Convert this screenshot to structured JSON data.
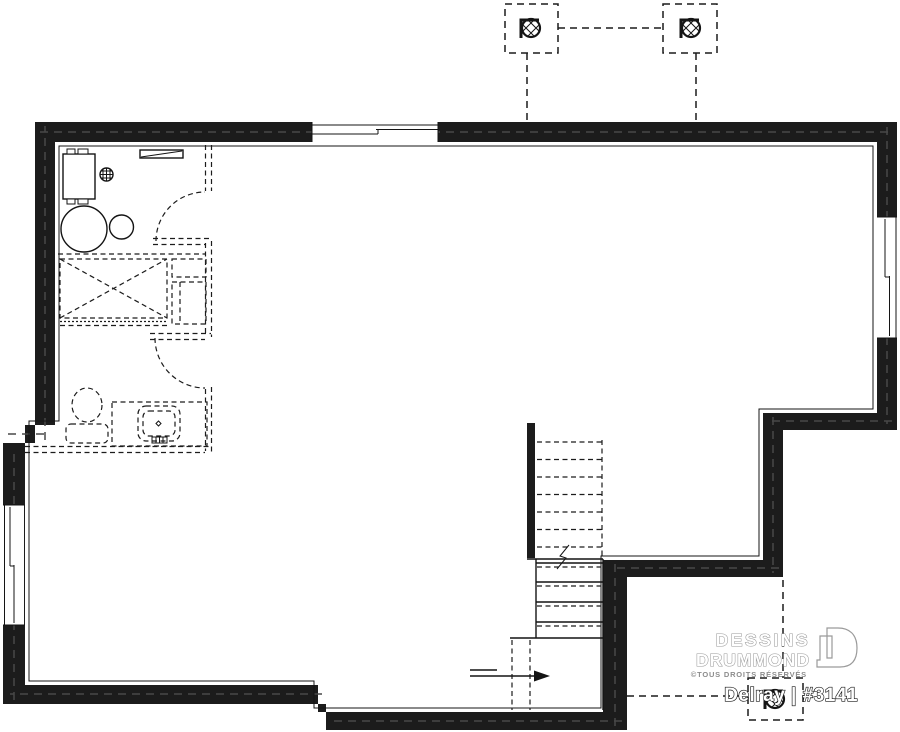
{
  "brand": {
    "name_line1": "DESSINS",
    "name_line2": "DRUMMOND",
    "rights": "©TOUS DROITS RÉSERVÉS",
    "plan_label": "Delray | #3141"
  },
  "colors": {
    "wall": "#1c1c1c",
    "line": "#141414",
    "logo_gray": "#9a9a9a",
    "background": "#ffffff"
  },
  "fixtures": [
    "exterior-foundation-wall",
    "window-top",
    "window-right",
    "window-left",
    "furnace-unit",
    "electrical-panel",
    "floor-drain",
    "water-heater",
    "pressure-tank",
    "future-bathroom-partition-dashed",
    "future-door-swing-upper",
    "future-door-swing-lower",
    "future-shower",
    "future-cabinets",
    "future-toilet",
    "future-vanity-sink",
    "staircase",
    "stair-direction-arrow",
    "post-footing-top-left",
    "post-footing-top-right",
    "post-footing-bottom-right",
    "deck-structure-dashed-lines"
  ]
}
